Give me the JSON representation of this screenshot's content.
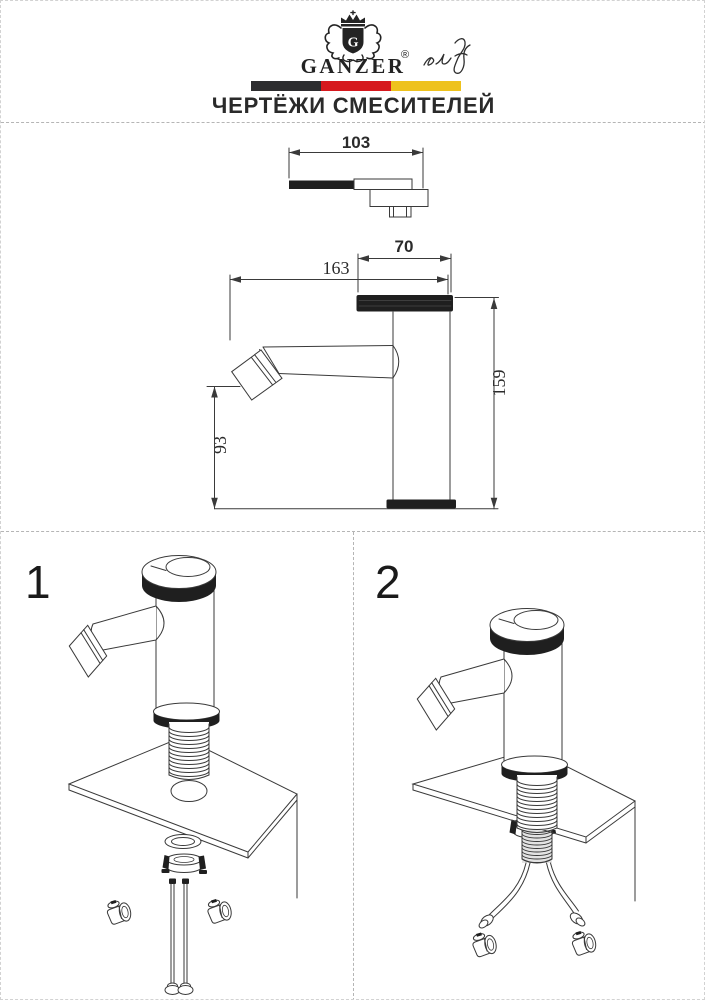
{
  "header": {
    "brand": "GANZER",
    "monogram": "G",
    "registered_mark": "®",
    "title": "ЧЕРТЁЖИ СМЕСИТЕЛЕЙ",
    "flag_bar_colors": {
      "black": "#2d2d2f",
      "red": "#d6191e",
      "yellow": "#eec21d"
    }
  },
  "drawing": {
    "dim_spout_top_view": "103",
    "dim_cap_width": "70",
    "dim_overall_length": "163",
    "dim_total_height": "159",
    "dim_spout_height": "93"
  },
  "figures": {
    "fig1": "1",
    "fig2": "2"
  },
  "colors": {
    "ink": "#3a3a3a",
    "dark_fill": "#1f1f1f"
  }
}
